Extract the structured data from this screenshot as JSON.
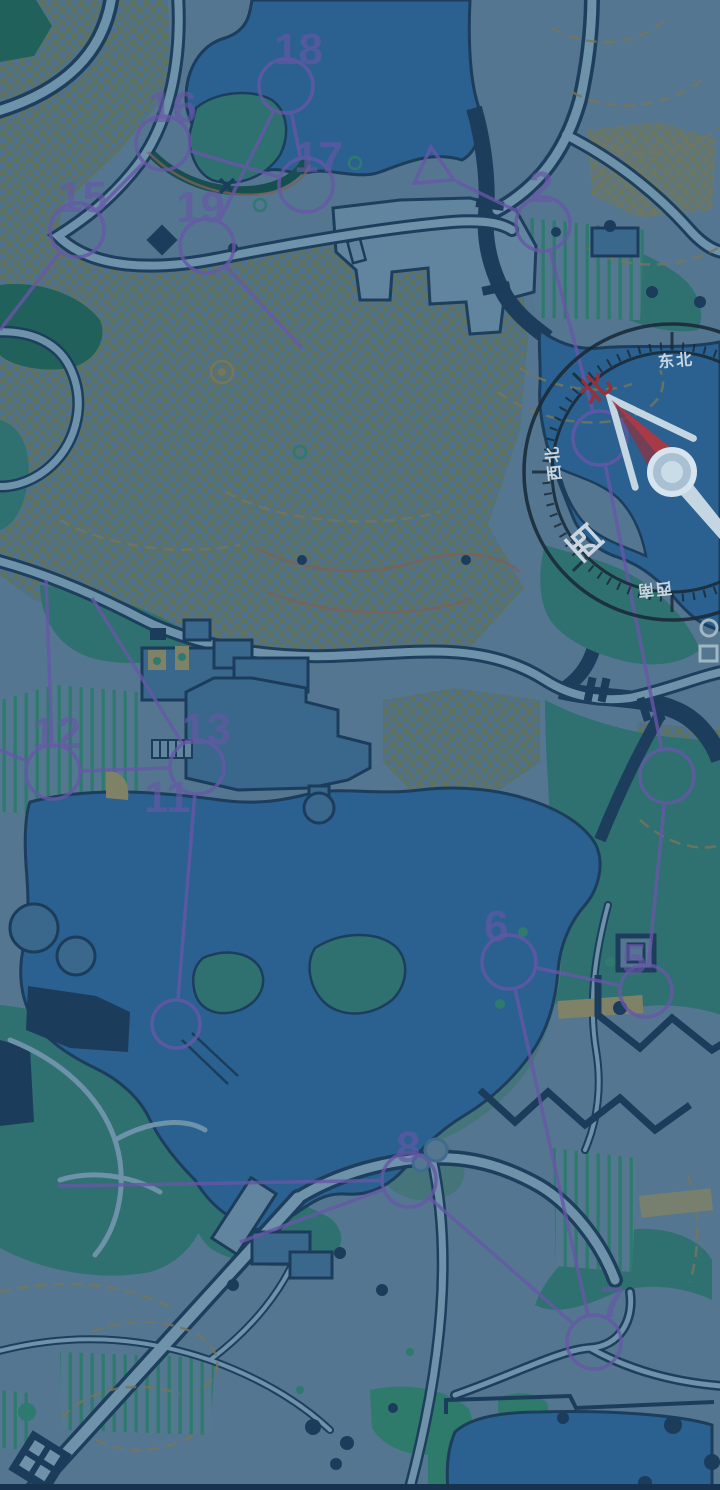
{
  "map": {
    "type": "orienteering-course-map",
    "course": {
      "color": "#6757A8",
      "start": {
        "label": "1",
        "x": 433,
        "y": 170,
        "angle": 25,
        "size": 23
      },
      "controls": [
        {
          "label": "15",
          "lx": 58,
          "ly": 212,
          "cx": 77,
          "cy": 230,
          "r": 27
        },
        {
          "label": "16",
          "lx": 148,
          "ly": 122,
          "cx": 163,
          "cy": 143,
          "r": 27
        },
        {
          "label": "17",
          "lx": 294,
          "ly": 172,
          "cx": 306,
          "cy": 185,
          "r": 27
        },
        {
          "label": "18",
          "lx": 274,
          "ly": 64,
          "cx": 286,
          "cy": 86,
          "r": 27
        },
        {
          "label": "19",
          "lx": 176,
          "ly": 222,
          "cx": 207,
          "cy": 246,
          "r": 27
        },
        {
          "label": "2",
          "lx": 529,
          "ly": 202,
          "cx": 543,
          "cy": 224,
          "r": 27
        },
        {
          "label": "5",
          "lx": 622,
          "ly": 974,
          "cx": 646,
          "cy": 991,
          "r": 26
        },
        {
          "label": "6",
          "lx": 484,
          "ly": 941,
          "cx": 509,
          "cy": 962,
          "r": 27
        },
        {
          "label": "7",
          "lx": 600,
          "ly": 1317,
          "cx": 594,
          "cy": 1342,
          "r": 27
        },
        {
          "label": "8",
          "lx": 396,
          "ly": 1162,
          "cx": 409,
          "cy": 1180,
          "r": 27
        },
        {
          "label": "11",
          "lx": 144,
          "ly": 812,
          "cx": null,
          "cy": null,
          "r": 27
        },
        {
          "label": "12",
          "lx": 32,
          "ly": 748,
          "cx": 53,
          "cy": 772,
          "r": 27
        },
        {
          "label": "13",
          "lx": 182,
          "ly": 744,
          "cx": 197,
          "cy": 767,
          "r": 27
        }
      ],
      "extra_circles": [
        {
          "cx": 600,
          "cy": 438,
          "r": 27
        },
        {
          "cx": 667,
          "cy": 776,
          "r": 27
        },
        {
          "cx": 176,
          "cy": 1024,
          "r": 24
        }
      ],
      "segments": [
        {
          "x1": 0,
          "y1": 330,
          "x2": 77,
          "y2": 230,
          "t1": 0,
          "t2": 29
        },
        {
          "x1": 77,
          "y1": 230,
          "x2": 163,
          "y2": 143,
          "t1": 29,
          "t2": 29
        },
        {
          "x1": 163,
          "y1": 143,
          "x2": 306,
          "y2": 185,
          "t1": 29,
          "t2": 29
        },
        {
          "x1": 306,
          "y1": 185,
          "x2": 286,
          "y2": 86,
          "t1": 29,
          "t2": 29
        },
        {
          "x1": 286,
          "y1": 86,
          "x2": 207,
          "y2": 246,
          "t1": 29,
          "t2": 29
        },
        {
          "x1": 207,
          "y1": 246,
          "x2": 302,
          "y2": 348,
          "t1": 29,
          "t2": 0
        },
        {
          "x1": 433,
          "y1": 170,
          "x2": 543,
          "y2": 224,
          "t1": 26,
          "t2": 29
        },
        {
          "x1": 543,
          "y1": 224,
          "x2": 600,
          "y2": 438,
          "t1": 29,
          "t2": 29
        },
        {
          "x1": 600,
          "y1": 438,
          "x2": 667,
          "y2": 776,
          "t1": 29,
          "t2": 29
        },
        {
          "x1": 667,
          "y1": 776,
          "x2": 646,
          "y2": 991,
          "t1": 29,
          "t2": 28
        },
        {
          "x1": 646,
          "y1": 991,
          "x2": 509,
          "y2": 962,
          "t1": 28,
          "t2": 29
        },
        {
          "x1": 509,
          "y1": 962,
          "x2": 594,
          "y2": 1342,
          "t1": 29,
          "t2": 29
        },
        {
          "x1": 594,
          "y1": 1342,
          "x2": 409,
          "y2": 1180,
          "t1": 29,
          "t2": 29
        },
        {
          "x1": 409,
          "y1": 1180,
          "x2": 240,
          "y2": 1242,
          "t1": 29,
          "t2": 0
        },
        {
          "x1": 58,
          "y1": 1186,
          "x2": 409,
          "y2": 1180,
          "t1": 0,
          "t2": 29
        },
        {
          "x1": 46,
          "y1": 580,
          "x2": 53,
          "y2": 772,
          "t1": 0,
          "t2": 29
        },
        {
          "x1": 53,
          "y1": 772,
          "x2": 197,
          "y2": 767,
          "t1": 29,
          "t2": 29
        },
        {
          "x1": 53,
          "y1": 772,
          "x2": 0,
          "y2": 750,
          "t1": 29,
          "t2": 0
        },
        {
          "x1": 92,
          "y1": 598,
          "x2": 197,
          "y2": 767,
          "t1": 0,
          "t2": 29
        },
        {
          "x1": 197,
          "y1": 767,
          "x2": 176,
          "y2": 1024,
          "t1": 29,
          "t2": 26
        }
      ]
    }
  },
  "compass": {
    "labels": {
      "n": "北",
      "ne": "东北",
      "nw": "西北",
      "w": "西",
      "sw": "西南"
    },
    "north_color": "#993039",
    "label_color": "#C9D6DF",
    "needle": {
      "red": "#A63A46",
      "red_dark": "#8E3340",
      "light": "#C3D6E2"
    },
    "rotation_deg": -42
  },
  "colors": {
    "water": "#2A6190",
    "land": "#547690",
    "forest": "#2F7170",
    "forest_dark": "#20615B",
    "outline": "#1D3D5C",
    "course": "#6757A8",
    "khaki": "#7F8266",
    "contour": "#77755A"
  }
}
